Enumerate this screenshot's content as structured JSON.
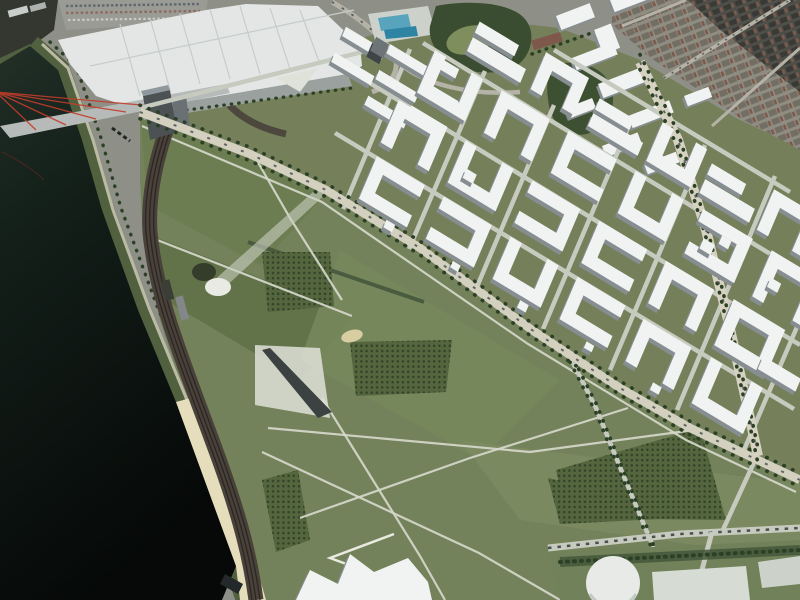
{
  "colors": {
    "photo_base": "#8e9087",
    "water_top": "#223028",
    "water_mid": "#14201a",
    "water_deep": "#060908",
    "bank_green": "#51613f",
    "tree_dark": "#2c4026",
    "promenade": "#c7c5ae",
    "beach_sand": "#e5ddbc",
    "rail_band": "#49413a",
    "rail_dark": "#2b2723",
    "bridge_deck": "#b6bab8",
    "cable_red": "#c23c2a",
    "halls_roof": "#e3e6e5",
    "halls_ridge": "#c6ccca",
    "halls_front": "#9aa19f",
    "plaza_light": "#dfe2d8",
    "plaza_dark": "#3b4241",
    "bridge_tower_face": "#4c5154",
    "bridge_tower_top": "#8f999d",
    "tower_roof": "#6d7478",
    "tower_facade": "#3f4447",
    "park_base": "#73825a",
    "park_patch_dark": "#5f7148",
    "park_patch_mid": "#6b7c50",
    "park_patch_light": "#77875c",
    "park_patch_low": "#7d8b62",
    "hedge_green": "#43553a",
    "grove_base": "#55663f",
    "path_light": "#d6d8cb",
    "quarter_ground": "#75805b",
    "street": "#c7cabf",
    "boulevard": "#d3d0bf",
    "avenue": "#d6d2c1",
    "block_roof": "#f1f3f2",
    "block_facade": "#878e92",
    "car_dark": "#4e5451",
    "city_a": "#8f8c82",
    "city_b": "#726e64",
    "roof_red": "#7e584a",
    "city_dark_a": "#4a4b45",
    "city_dark_b": "#333431",
    "city_street": "#b5b2a7",
    "woods": "#3a4d30",
    "lawn_light": "#7f8e5d",
    "pool_deck": "#ccd1cb",
    "pool_blue": "#58a4bc",
    "pool_blue2": "#2f84a3",
    "parking": "#999b94",
    "dome_white": "#e9eae3",
    "dome_shadow": "#2c3424",
    "streak_light": "#c9cec2",
    "tank_white": "#e8eae7",
    "sport_field": "#d6dbd3",
    "stairs_light": "#e8eadf",
    "sand_patch": "#d8cea2",
    "dark_corner": "#34372f"
  },
  "scene": {
    "blocks": [
      {
        "t": "slab",
        "u": -48,
        "v": 118,
        "w": 46,
        "h": 10
      },
      {
        "t": "slab",
        "u": -48,
        "v": 146,
        "w": 46,
        "h": 10
      },
      {
        "t": "slab",
        "u": 0,
        "v": 98,
        "w": 46,
        "h": 10
      },
      {
        "t": "slab",
        "u": 0,
        "v": 126,
        "w": 46,
        "h": 10
      },
      {
        "t": "slab",
        "u": 0,
        "v": 154,
        "w": 46,
        "h": 10
      },
      {
        "t": "slab",
        "u": 44,
        "v": 112,
        "w": 42,
        "h": 10
      },
      {
        "t": "slab",
        "u": 44,
        "v": 140,
        "w": 42,
        "h": 10
      },
      {
        "t": "slab",
        "u": 44,
        "v": 168,
        "w": 30,
        "h": 10
      },
      {
        "t": "tower",
        "u": -16,
        "v": 148,
        "w": 15,
        "h": 15
      },
      {
        "t": "u1",
        "u": 32,
        "v": 14
      },
      {
        "t": "u3",
        "u": 110,
        "v": 14
      },
      {
        "t": "u0",
        "u": 188,
        "v": 14
      },
      {
        "t": "u1",
        "u": 266,
        "v": 14
      },
      {
        "t": "u2",
        "u": 344,
        "v": 12
      },
      {
        "t": "u0",
        "u": 422,
        "v": 10,
        "w": 60,
        "h": 50
      },
      {
        "t": "u2",
        "u": 30,
        "v": 74
      },
      {
        "t": "u0",
        "u": 108,
        "v": 74
      },
      {
        "t": "u3",
        "u": 186,
        "v": 74
      },
      {
        "t": "u1",
        "u": 264,
        "v": 74
      },
      {
        "t": "u2",
        "u": 342,
        "v": 74
      },
      {
        "t": "o",
        "u": 420,
        "v": 72,
        "w": 60,
        "h": 50
      },
      {
        "t": "u0",
        "u": 44,
        "v": 136
      },
      {
        "t": "u2",
        "u": 122,
        "v": 136
      },
      {
        "t": "u1",
        "u": 200,
        "v": 136
      },
      {
        "t": "u0",
        "u": 278,
        "v": 136
      },
      {
        "t": "u3",
        "u": 356,
        "v": 136,
        "w": 58,
        "h": 48
      },
      {
        "t": "u2",
        "u": 436,
        "v": 134,
        "w": 60,
        "h": 50
      },
      {
        "t": "slab",
        "u": 74,
        "v": 198,
        "w": 62,
        "h": 15
      },
      {
        "t": "slab",
        "u": 74,
        "v": 218,
        "w": 46,
        "h": 12
      },
      {
        "t": "u2",
        "u": 148,
        "v": 198,
        "w": 50,
        "h": 40
      },
      {
        "t": "slab",
        "u": 216,
        "v": 196,
        "w": 58,
        "h": 14
      },
      {
        "t": "slab",
        "u": 216,
        "v": 214,
        "w": 40,
        "h": 12
      },
      {
        "t": "u0",
        "u": 284,
        "v": 196,
        "w": 52,
        "h": 42
      },
      {
        "t": "slab",
        "u": 346,
        "v": 196,
        "w": 58,
        "h": 15
      },
      {
        "t": "slab",
        "u": 346,
        "v": 216,
        "w": 40,
        "h": 12
      },
      {
        "t": "u2",
        "u": 414,
        "v": 194,
        "w": 54,
        "h": 44
      },
      {
        "t": "slab",
        "u": 476,
        "v": 194,
        "w": 40,
        "h": 14
      },
      {
        "t": "u0",
        "u": 500,
        "v": 134,
        "w": 54,
        "h": 46
      },
      {
        "t": "slab",
        "u": 470,
        "v": 74,
        "w": 44,
        "h": 14
      },
      {
        "t": "slab",
        "u": 368,
        "v": 148,
        "w": 13,
        "h": 11
      },
      {
        "t": "slab",
        "u": 384,
        "v": 162,
        "w": 11,
        "h": 9
      },
      {
        "t": "slab",
        "u": 446,
        "v": 150,
        "w": 12,
        "h": 10
      },
      {
        "t": "slab",
        "u": 120,
        "v": 86,
        "w": 12,
        "h": 10
      },
      {
        "t": "slab",
        "u": 66,
        "v": 2,
        "w": 10,
        "h": 8
      },
      {
        "t": "slab",
        "u": 144,
        "v": 2,
        "w": 9,
        "h": 7
      },
      {
        "t": "slab",
        "u": 222,
        "v": 2,
        "w": 10,
        "h": 8
      },
      {
        "t": "slab",
        "u": 300,
        "v": 2,
        "w": 9,
        "h": 7
      },
      {
        "t": "slab",
        "u": 378,
        "v": 0,
        "w": 10,
        "h": 8
      }
    ],
    "abs_blocks": [
      {
        "x": 556,
        "y": 16,
        "w": 36,
        "h": 15
      },
      {
        "x": 594,
        "y": 30,
        "w": 18,
        "h": 26
      },
      {
        "x": 610,
        "y": 0,
        "w": 42,
        "h": 13
      },
      {
        "x": 572,
        "y": 58,
        "w": 44,
        "h": 13
      },
      {
        "x": 598,
        "y": 84,
        "w": 52,
        "h": 15
      },
      {
        "x": 566,
        "y": 108,
        "w": 28,
        "h": 11
      },
      {
        "x": 628,
        "y": 116,
        "w": 44,
        "h": 13
      },
      {
        "x": 602,
        "y": 146,
        "w": 38,
        "h": 12
      },
      {
        "x": 644,
        "y": 164,
        "w": 34,
        "h": 11
      },
      {
        "x": 684,
        "y": 96,
        "w": 26,
        "h": 11
      }
    ],
    "streets": {
      "cross": [
        [
          343,
          209,
          410,
          49
        ],
        [
          409,
          249,
          485,
          71
        ],
        [
          476,
          289,
          554,
          105
        ],
        [
          543,
          329,
          630,
          123
        ],
        [
          610,
          370,
          705,
          145
        ],
        [
          677,
          410,
          775,
          176
        ],
        [
          744,
          450,
          800,
          320
        ]
      ],
      "parallel": [
        [
          335,
          133,
          794,
          409
        ],
        [
          347,
          69,
          800,
          345
        ],
        [
          423,
          43,
          800,
          272
        ],
        [
          554,
          50,
          790,
          192
        ]
      ],
      "extra": [
        [
          140,
          108,
          362,
          52
        ],
        [
          756,
          458,
          722,
          532
        ]
      ]
    },
    "boulevard": [
      [
        140,
        112
      ],
      [
        250,
        154
      ],
      [
        326,
        190
      ],
      [
        420,
        248
      ],
      [
        532,
        330
      ],
      [
        620,
        388
      ],
      [
        690,
        428
      ],
      [
        800,
        480
      ]
    ],
    "avenue": [
      [
        640,
        62
      ],
      [
        678,
        140
      ],
      [
        706,
        230
      ],
      [
        728,
        320
      ],
      [
        746,
        400
      ],
      [
        758,
        456
      ]
    ],
    "park_roads": [
      [
        [
          570,
          357
        ],
        [
          596,
          408
        ],
        [
          622,
          472
        ],
        [
          652,
          544
        ],
        [
          664,
          600
        ]
      ]
    ],
    "park_paths": [
      "252,152 290,218 342,300",
      "152,238 352,316",
      "262,452 479,553 560,600",
      "322,398 420,556 445,600",
      "300,518 470,458 628,408",
      "268,428 530,452 694,430",
      "142,126 322,202 528,344 686,440 796,492"
    ],
    "groves": [
      "262,252 330,252 334,306 268,312",
      "350,342 452,340 446,392 356,396",
      "556,470 700,428 726,520 566,518",
      "548,478 720,516 560,524",
      "262,480 298,470 310,540 276,552"
    ]
  }
}
